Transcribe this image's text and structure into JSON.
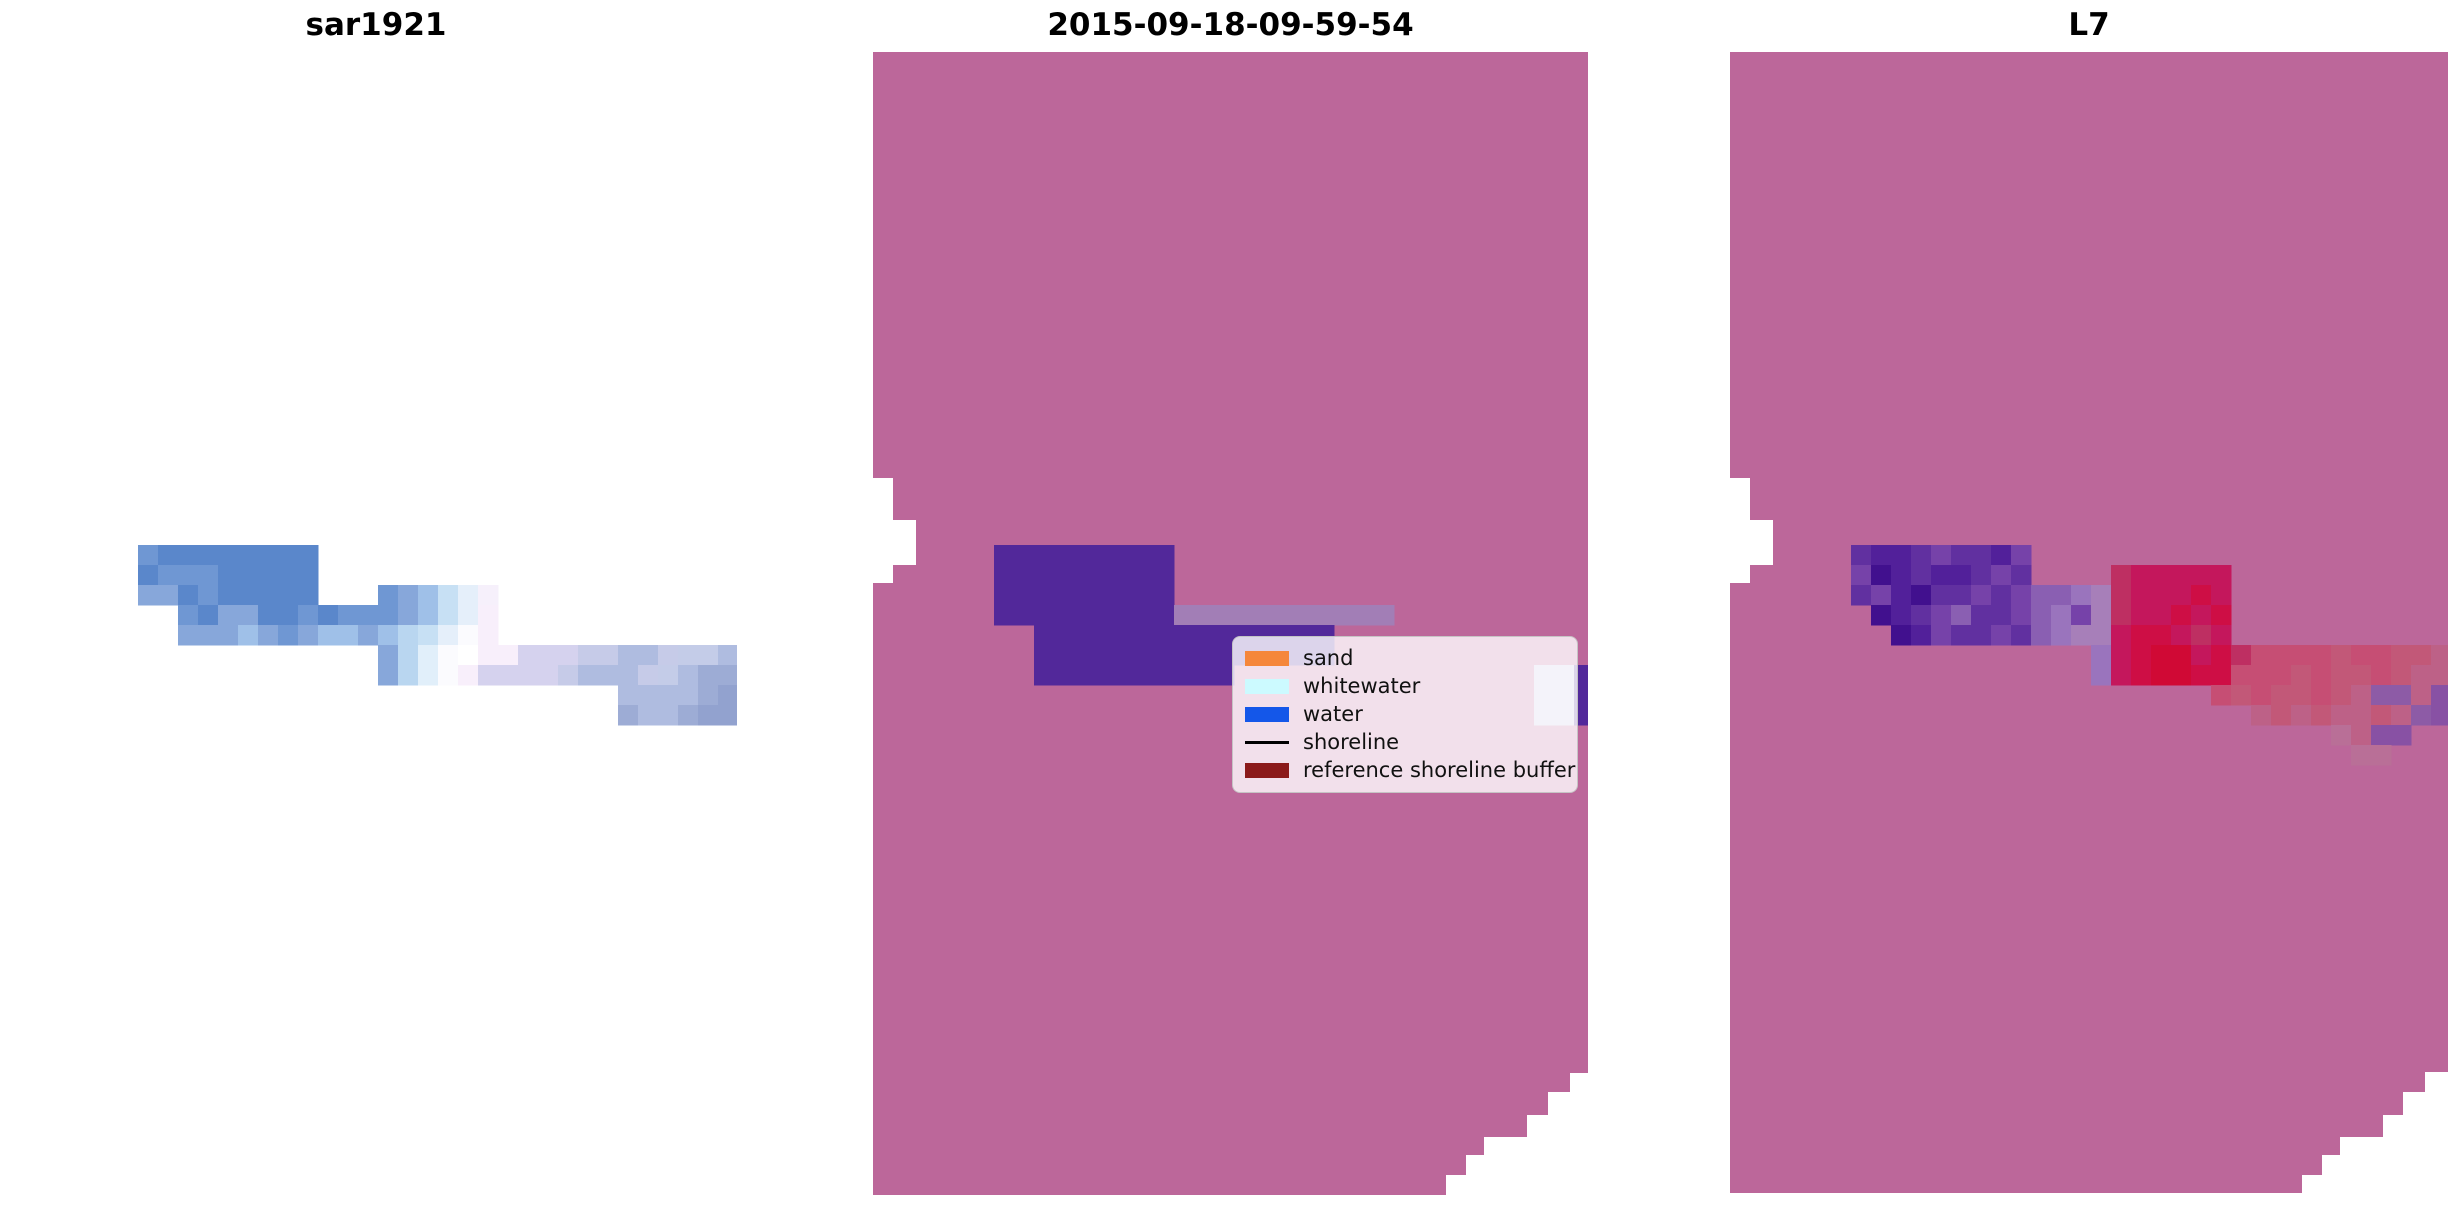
{
  "figure": {
    "width": 2460,
    "height": 1212,
    "background": "#ffffff"
  },
  "panels": [
    {
      "id": "sar1921",
      "title": "sar1921",
      "bounds": {
        "x": 15,
        "y": 49,
        "w": 722,
        "h": 1146
      },
      "bg": null,
      "shape": null,
      "notches": [],
      "grid": {
        "x": 138,
        "y": 545,
        "cell": 20,
        "palette": {
          "a": "#5a87cb",
          "b": "#6f97d3",
          "c": "#87a7da",
          "d": "#9fc0e8",
          "e": "#c7e0f4",
          "f": "#e5effa",
          "g": "#f6f0fb",
          "h": "#fbfbfe",
          "i": "#ffffff",
          "j": "#f8effb",
          "k": "#d5d2ee",
          "l": "#c6cbe8",
          "m": "#afbce0",
          "n": "#c4cce8",
          "o": "#9dacd5",
          "p": "#92a2cf",
          "q": "#b9d6f0",
          "r": "#e1effa"
        },
        "rows": [
          {
            "start": 0,
            "px": "baaaaaaaa"
          },
          {
            "start": 0,
            "px": "abbbaaaaa"
          },
          {
            "start": 0,
            "px": "ccabaaaaa...bcdefg"
          },
          {
            "start": 2,
            "px": "baccaababbbcdefj"
          },
          {
            "start": 2,
            "px": "cccdcbcddcdqefhj"
          },
          {
            "start": 12,
            "px": "cqrhijjkkkllmmlnnm"
          },
          {
            "start": 12,
            "px": "cqrhjkkkklmmmlnmoo"
          },
          {
            "start": 24,
            "px": "mmmmop"
          },
          {
            "start": 24,
            "px": "ommopp"
          }
        ]
      }
    },
    {
      "id": "classified",
      "title": "2015-09-18-09-59-54",
      "bounds": {
        "x": 873,
        "y": 49,
        "w": 715,
        "h": 1146
      },
      "bg": "#bc679a",
      "shape": "M873,52 L1588,52 L1588,1073 L1570,1073 L1570,1092 L1548,1092 L1548,1115 L1527,1115 L1527,1137 L1484,1137 L1484,1155 L1466,1155 L1466,1175 L1446,1175 L1446,1195 L873,1195 Z",
      "notches": [
        [
          873,
          478,
          20,
          105
        ],
        [
          893,
          520,
          23,
          45
        ]
      ],
      "grid": {
        "x": 994,
        "y": 545,
        "cell": 20,
        "palette": {
          "V": "#52289a",
          "L": "#a27eb6",
          "W": "#c5c4e4"
        },
        "rows": [
          {
            "start": 0,
            "px": "VVVVVVVVV"
          },
          {
            "start": 0,
            "px": "VVVVVVVVV"
          },
          {
            "start": 0,
            "px": "VVVVVVVVV"
          },
          {
            "start": 0,
            "px": "VVVVVVVVVLLLLLLLLLLL"
          },
          {
            "start": 2,
            "px": "VVVVVVVVVVVVVVV"
          },
          {
            "start": 2,
            "px": "VVVVVVVVVVVVVVV"
          },
          {
            "start": 2,
            "px": "VVVVVVVVVV...............WWV"
          },
          {
            "start": 27,
            "px": "WWV"
          },
          {
            "start": 27,
            "px": "WWV"
          }
        ]
      }
    },
    {
      "id": "l7",
      "title": "L7",
      "bounds": {
        "x": 1730,
        "y": 49,
        "w": 718,
        "h": 1146
      },
      "bg": "#bc679a",
      "shape": "M1730,52 L2448,52 L2448,1072 L2425,1072 L2425,1092 L2403,1092 L2403,1115 L2383,1115 L2383,1137 L2340,1137 L2340,1155 L2322,1155 L2322,1175 L2302,1175 L2302,1193 L1730,1193 Z",
      "notches": [
        [
          1730,
          478,
          20,
          105
        ],
        [
          1750,
          520,
          23,
          45
        ]
      ],
      "grid": {
        "x": 1851,
        "y": 545,
        "cell": 20,
        "palette": {
          "U": "#41108e",
          "V": "#52209a",
          "X": "#6130a0",
          "Y": "#7642a9",
          "Z": "#8a5fb2",
          "T": "#9a74bd",
          "s": "#a77fb9",
          "A": "#c4175c",
          "B": "#ce0e45",
          "C": "#d00935",
          "D": "#be2f62",
          "E": "#c64e74",
          "F": "#c25878",
          "G": "#bd6187",
          "H": "#b96f97",
          "P": "#8d5ba6",
          "Q": "#8851a4"
        },
        "rows": [
          {
            "start": 0,
            "px": "XVVXYXXVY"
          },
          {
            "start": 0,
            "px": "YUVXVVXYX....DAAAAA"
          },
          {
            "start": 0,
            "px": "XYVUXXYXYZZTsDAAABA"
          },
          {
            "start": 1,
            "px": "UVXYZXXYZTYsDAABAB"
          },
          {
            "start": 2,
            "px": "UVYXXYXZTssABBADA"
          },
          {
            "start": 12,
            "px": "TABCCABDEEEEFEEFFG"
          },
          {
            "start": 12,
            "px": "TABCCBBEEEFEFFEFGG"
          },
          {
            "start": 18,
            "px": "EFEFFEFGPPGQ"
          },
          {
            "start": 20,
            "px": "GFGFGGFGPQ"
          },
          {
            "start": 24,
            "px": "HGQQ"
          },
          {
            "start": 25,
            "px": "HH"
          }
        ]
      }
    }
  ],
  "legend": {
    "entries": [
      {
        "label": "sand",
        "type": "patch",
        "color": "#f5873b"
      },
      {
        "label": "whitewater",
        "type": "patch",
        "color": "#ccfaff"
      },
      {
        "label": "water",
        "type": "patch",
        "color": "#1457e9"
      },
      {
        "label": "shoreline",
        "type": "line",
        "color": "#000000"
      },
      {
        "label": "reference shoreline buffer",
        "type": "patch",
        "color": "#8b1a1a"
      }
    ]
  },
  "chart_data": {
    "type": "heatmap",
    "title": "",
    "panel_titles": [
      "sar1921",
      "2015-09-18-09-59-54",
      "L7"
    ],
    "legend_entries": [
      "sand",
      "whitewater",
      "water",
      "shoreline",
      "reference shoreline buffer"
    ],
    "legend_colors": [
      "#f5873b",
      "#ccfaff",
      "#1457e9",
      "#000000",
      "#8b1a1a"
    ],
    "panel_background_colors": [
      "#ffffff",
      "#bc679a",
      "#bc679a"
    ],
    "grid": "off",
    "legend_position": "right-center of middle panel"
  }
}
